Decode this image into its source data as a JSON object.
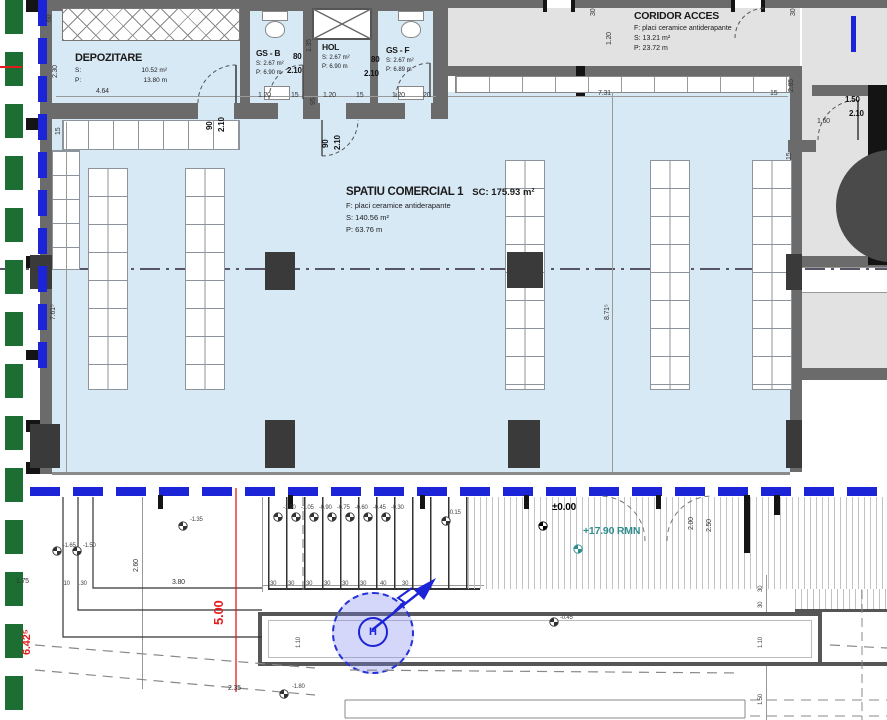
{
  "rooms": {
    "depozitare": {
      "name": "DEPOZITARE",
      "s_label": "S:",
      "s_value": "10.52 m²",
      "p_label": "P:",
      "p_value": "13.80 m"
    },
    "gs_b": {
      "name": "GS - B",
      "s": "S: 2.67 m²",
      "p": "P: 6.90 m"
    },
    "hol": {
      "name": "HOL",
      "s": "S: 2.67 m²",
      "p": "P: 6.90 m"
    },
    "gs_f": {
      "name": "GS - F",
      "s": "S: 2.67 m²",
      "p": "P: 6.89 m"
    },
    "coridor": {
      "name": "CORIDOR ACCES",
      "f": "F: placi ceramice antiderapante",
      "s": "S: 13.21 m²",
      "p": "P: 23.72 m"
    },
    "spatiu": {
      "name": "SPATIU COMERCIAL 1",
      "sc": "SC: 175.93 m²",
      "f": "F: placi ceramice antiderapante",
      "s": "S: 140.56 m²",
      "p": "P: 63.76 m"
    }
  },
  "hydrant": {
    "symbol": "H"
  },
  "colors": {
    "room_fill": "#d8e9f6",
    "corridor_fill": "#e2e2e2",
    "wall": "#6b6b6b",
    "facade_blue": "#1c24d8",
    "boundary_green": "#1d6e33",
    "dim_red": "#e31c1c",
    "level_teal": "#2f8d8d"
  },
  "dims": [
    {
      "t": "4.64",
      "x": 96,
      "y": 88
    },
    {
      "t": "1.20",
      "x": 258,
      "y": 92
    },
    {
      "t": "15",
      "x": 291,
      "y": 92
    },
    {
      "t": "1.20",
      "x": 323,
      "y": 92
    },
    {
      "t": "15",
      "x": 356,
      "y": 92
    },
    {
      "t": "1.20",
      "x": 392,
      "y": 92
    },
    {
      "t": "20",
      "x": 423,
      "y": 92
    },
    {
      "t": "80",
      "x": 293,
      "y": 53,
      "c": "b"
    },
    {
      "t": "2.10",
      "x": 287,
      "y": 67,
      "c": "b"
    },
    {
      "t": "80",
      "x": 371,
      "y": 56,
      "c": "b"
    },
    {
      "t": "2.10",
      "x": 364,
      "y": 70,
      "c": "b"
    },
    {
      "t": "7.31",
      "x": 598,
      "y": 90
    },
    {
      "t": "15",
      "x": 770,
      "y": 90
    },
    {
      "t": "1.50",
      "x": 845,
      "y": 96,
      "c": "b"
    },
    {
      "t": "2.10",
      "x": 849,
      "y": 110,
      "c": "b"
    },
    {
      "t": "1.60",
      "x": 817,
      "y": 118
    },
    {
      "t": "±0.00",
      "x": 552,
      "y": 503,
      "c": "lvl"
    },
    {
      "t": "+17.90 RMN",
      "x": 583,
      "y": 526,
      "c": "teal"
    },
    {
      "t": "-1.20",
      "x": 283,
      "y": 505,
      "c": "s"
    },
    {
      "t": "-1.05",
      "x": 301,
      "y": 505,
      "c": "s"
    },
    {
      "t": "-0.90",
      "x": 319,
      "y": 505,
      "c": "s"
    },
    {
      "t": "-0.75",
      "x": 337,
      "y": 505,
      "c": "s"
    },
    {
      "t": "-0.60",
      "x": 355,
      "y": 505,
      "c": "s"
    },
    {
      "t": "-0.45",
      "x": 373,
      "y": 505,
      "c": "s"
    },
    {
      "t": "-0.30",
      "x": 391,
      "y": 505,
      "c": "s"
    },
    {
      "t": "-0.15",
      "x": 448,
      "y": 510,
      "c": "s"
    },
    {
      "t": "-1.65",
      "x": 63,
      "y": 543,
      "c": "s"
    },
    {
      "t": "-1.50",
      "x": 83,
      "y": 543,
      "c": "s"
    },
    {
      "t": "-1.35",
      "x": 190,
      "y": 517,
      "c": "s"
    },
    {
      "t": ".10",
      "x": 62,
      "y": 581,
      "c": "s"
    },
    {
      "t": ".30",
      "x": 79,
      "y": 581,
      "c": "s"
    },
    {
      "t": "3.80",
      "x": 172,
      "y": 579
    },
    {
      "t": "1.75",
      "x": 16,
      "y": 578
    },
    {
      "t": "-1.80",
      "x": 292,
      "y": 684,
      "c": "s"
    },
    {
      "t": "-0.45",
      "x": 560,
      "y": 615,
      "c": "s"
    },
    {
      "t": "2.35",
      "x": 228,
      "y": 685
    },
    {
      "t": "30",
      "x": 270,
      "y": 581,
      "c": "s"
    },
    {
      "t": "30",
      "x": 288,
      "y": 581,
      "c": "s"
    },
    {
      "t": "30",
      "x": 306,
      "y": 581,
      "c": "s"
    },
    {
      "t": "30",
      "x": 324,
      "y": 581,
      "c": "s"
    },
    {
      "t": "30",
      "x": 342,
      "y": 581,
      "c": "s"
    },
    {
      "t": "30",
      "x": 360,
      "y": 581,
      "c": "s"
    },
    {
      "t": "40",
      "x": 380,
      "y": 581,
      "c": "s"
    },
    {
      "t": "30",
      "x": 402,
      "y": 581,
      "c": "s"
    },
    {
      "t": "60",
      "x": 46,
      "y": 22,
      "r": -90
    },
    {
      "t": "2.30",
      "x": 52,
      "y": 78,
      "r": -90
    },
    {
      "t": "90",
      "x": 206,
      "y": 130,
      "r": -90,
      "c": "b"
    },
    {
      "t": "2.10",
      "x": 218,
      "y": 132,
      "r": -90,
      "c": "b"
    },
    {
      "t": "1.35",
      "x": 306,
      "y": 52,
      "r": -90
    },
    {
      "t": "95",
      "x": 310,
      "y": 105,
      "r": -90
    },
    {
      "t": "90",
      "x": 322,
      "y": 148,
      "r": -90,
      "c": "b"
    },
    {
      "t": "2.10",
      "x": 334,
      "y": 150,
      "r": -90,
      "c": "b"
    },
    {
      "t": "1.20",
      "x": 606,
      "y": 45,
      "r": -90
    },
    {
      "t": "30",
      "x": 590,
      "y": 16,
      "r": -90
    },
    {
      "t": "30",
      "x": 790,
      "y": 16,
      "r": -90
    },
    {
      "t": "2.85",
      "x": 788,
      "y": 92,
      "r": -90
    },
    {
      "t": "15",
      "x": 786,
      "y": 160,
      "r": -90
    },
    {
      "t": "15",
      "x": 55,
      "y": 135,
      "r": -90
    },
    {
      "t": "7.61⁵",
      "x": 50,
      "y": 320,
      "r": -90
    },
    {
      "t": "8.71⁵",
      "x": 604,
      "y": 320,
      "r": -90
    },
    {
      "t": "5.00",
      "x": 212,
      "y": 625,
      "r": -90,
      "c": "red"
    },
    {
      "t": "6.42⁵",
      "x": 22,
      "y": 655,
      "r": -90,
      "c": "red2"
    },
    {
      "t": "2.00",
      "x": 688,
      "y": 530,
      "r": -90
    },
    {
      "t": "2.50",
      "x": 706,
      "y": 532,
      "r": -90
    },
    {
      "t": "2.60",
      "x": 133,
      "y": 572,
      "r": -90
    },
    {
      "t": "30",
      "x": 758,
      "y": 592,
      "r": -90,
      "c": "s"
    },
    {
      "t": "30",
      "x": 758,
      "y": 608,
      "r": -90,
      "c": "s"
    },
    {
      "t": "1.10",
      "x": 758,
      "y": 648,
      "r": -90,
      "c": "s"
    },
    {
      "t": "1.50",
      "x": 758,
      "y": 705,
      "r": -90,
      "c": "s"
    },
    {
      "t": "1.10",
      "x": 296,
      "y": 648,
      "r": -90,
      "c": "s"
    }
  ]
}
